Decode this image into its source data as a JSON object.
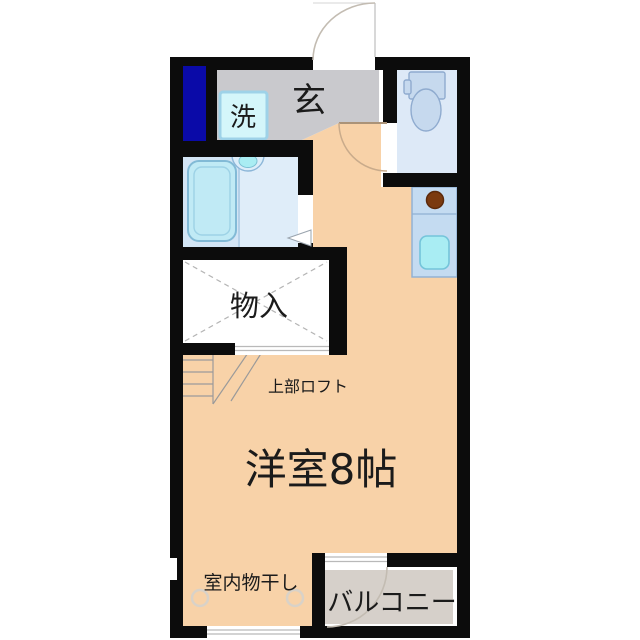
{
  "plan": {
    "type": "japanese-apartment-floor-plan-1R-loft",
    "rooms": {
      "entrance": {
        "label": "玄"
      },
      "laundry": {
        "label": "洗"
      },
      "storage": {
        "label": "物入"
      },
      "loft_note": {
        "label": "上部ロフト"
      },
      "main_room": {
        "label": "洋室8帖"
      },
      "drying_note": {
        "label": "室内物干し"
      },
      "balcony": {
        "label": "バルコニー"
      }
    },
    "fixtures": {
      "toilet": "toilet-with-tank",
      "bathtub": "bathtub",
      "bath_sink": "washbasin",
      "kitchen_counter": "kitchen-counter",
      "kitchen_sink": "kitchen-sink",
      "stove_burner": "single-burner-stove",
      "washer_space": "washing-machine-space",
      "pipe_space": "pipe-space",
      "stairs": "steps-to-loft",
      "drying_hooks": "indoor-drying-hooks",
      "entrance_door": "entrance-swing-door",
      "room_door": "interior-swing-door",
      "balcony_door": "balcony-swing-door",
      "bath_door": "folding-bath-door",
      "closet_door": "sliding-closet-door",
      "window": "bottom-window"
    },
    "colors": {
      "wall": "#0c0c0c",
      "room_floor": "#f8d2a8",
      "entrance_floor": "#c9c9cd",
      "balcony_floor": "#d6d0ca",
      "bath_floor": "#d3e5f5",
      "bath_floor_light": "#dfedf9",
      "toilet_floor": "#dde9f7",
      "closet_floor": "#ffffff",
      "fixture_fill": "#c6d9ee",
      "fixture_stroke": "#8fabcf",
      "tub_fill": "#c0eaf5",
      "sink_fill": "#a9edf3",
      "counter_fill": "#c4dbf1",
      "washer_fill": "#d4f6fa",
      "pipe_space": "#0a0aa8",
      "burner": "#7b3a10",
      "door_arc": "#c3bcb2",
      "text": "#1b1b1b"
    }
  }
}
